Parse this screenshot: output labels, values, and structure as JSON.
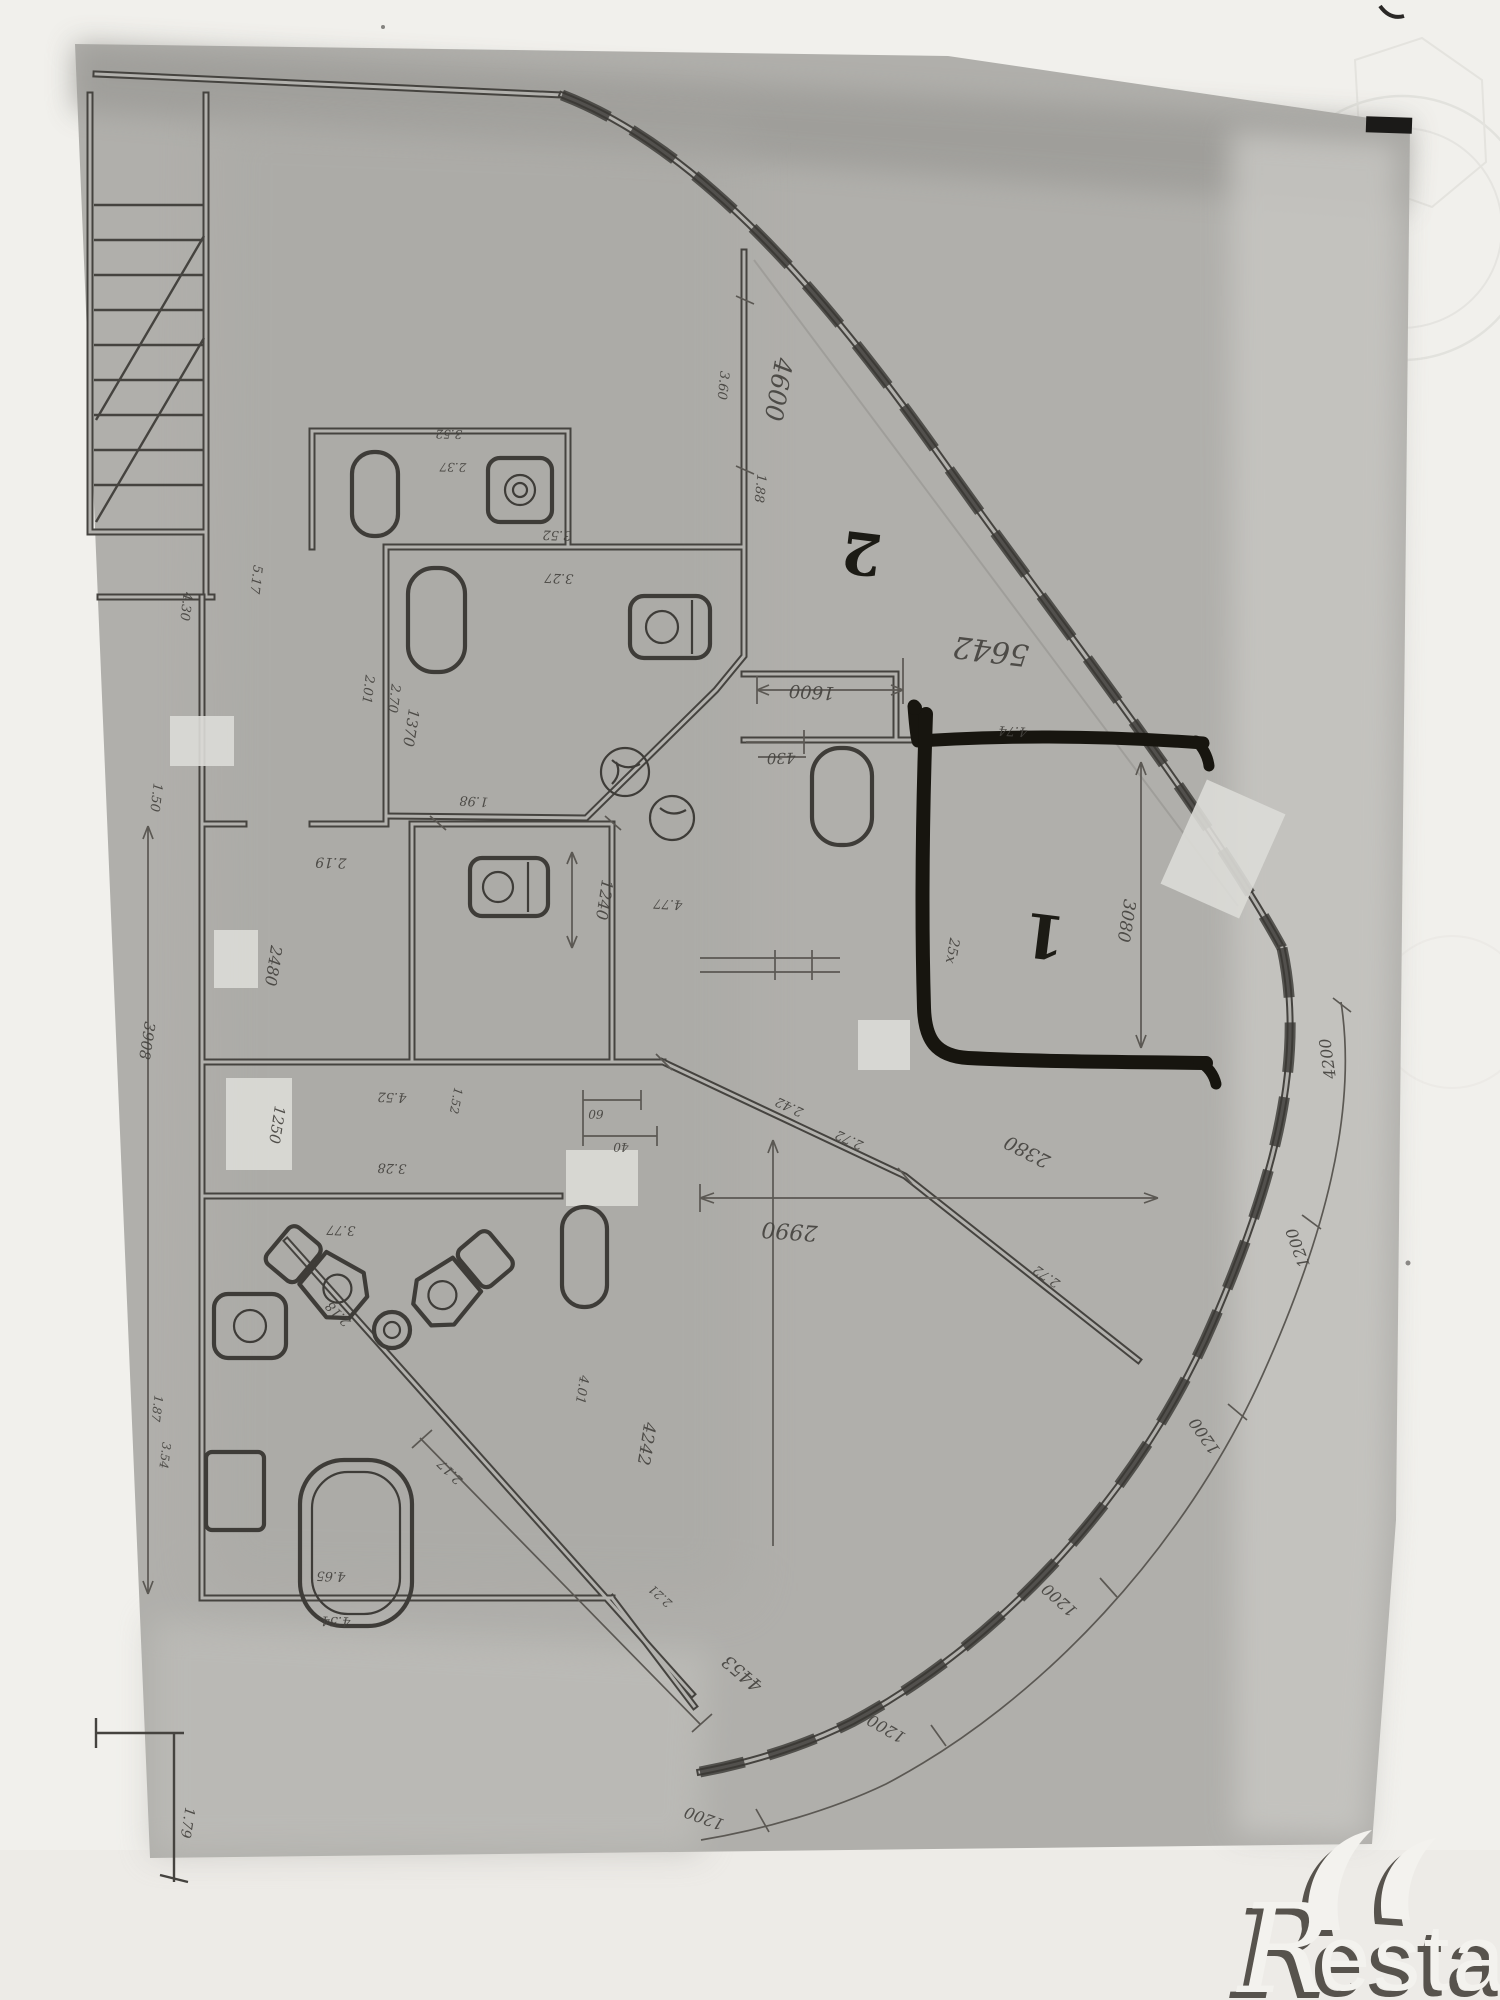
{
  "colors": {
    "paper": "#f1f0ec",
    "sheet": "#b0afab",
    "ink": "#45433f",
    "marker": "#17150f",
    "wmshadow": "#57534d"
  },
  "watermark": {
    "letter_r": "R",
    "rest": "estate"
  },
  "plan": {
    "room_numbers": [
      "1",
      "2"
    ],
    "labels": [
      {
        "t": "2",
        "x": 864,
        "y": 533,
        "r": 187,
        "s": 58,
        "m": 1,
        "n": "room-number-2"
      },
      {
        "t": "1",
        "x": 1047,
        "y": 915,
        "r": 187,
        "s": 60,
        "m": 1,
        "n": "room-number-1"
      },
      {
        "t": "4600",
        "x": 770,
        "y": 388,
        "r": 100,
        "s": 25
      },
      {
        "t": "3.60",
        "x": 719,
        "y": 385,
        "r": 96,
        "s": 13
      },
      {
        "t": "1.88",
        "x": 756,
        "y": 488,
        "r": 96,
        "s": 13
      },
      {
        "t": "5642",
        "x": 992,
        "y": 641,
        "r": 187,
        "s": 30,
        "i": 1
      },
      {
        "t": "1600",
        "x": 812,
        "y": 686,
        "r": 183,
        "s": 18
      },
      {
        "t": "430",
        "x": 781,
        "y": 753,
        "r": 179,
        "s": 15
      },
      {
        "t": "4.74",
        "x": 1013,
        "y": 727,
        "r": 183,
        "s": 13
      },
      {
        "t": "25x",
        "x": 948,
        "y": 950,
        "r": 100,
        "s": 14,
        "i": 1
      },
      {
        "t": "3080",
        "x": 1121,
        "y": 920,
        "r": 99,
        "s": 17
      },
      {
        "t": "3.52",
        "x": 449,
        "y": 430,
        "r": 181,
        "s": 12
      },
      {
        "t": "2.37",
        "x": 453,
        "y": 463,
        "r": 181,
        "s": 12
      },
      {
        "t": "3.52",
        "x": 557,
        "y": 531,
        "r": 182,
        "s": 13
      },
      {
        "t": "3.27",
        "x": 559,
        "y": 574,
        "r": 182,
        "s": 13
      },
      {
        "t": "2.01",
        "x": 364,
        "y": 689,
        "r": 97,
        "s": 13
      },
      {
        "t": "2.70",
        "x": 390,
        "y": 698,
        "r": 97,
        "s": 13
      },
      {
        "t": "1370",
        "x": 406,
        "y": 727,
        "r": 99,
        "s": 15
      },
      {
        "t": "1.98",
        "x": 474,
        "y": 797,
        "r": 183,
        "s": 13
      },
      {
        "t": "1.50",
        "x": 152,
        "y": 797,
        "r": 97,
        "s": 13
      },
      {
        "t": "2.19",
        "x": 331,
        "y": 858,
        "r": 182,
        "s": 14
      },
      {
        "t": "4.77",
        "x": 668,
        "y": 900,
        "r": 183,
        "s": 13
      },
      {
        "t": "1240",
        "x": 599,
        "y": 899,
        "r": 99,
        "s": 16
      },
      {
        "t": "4.30",
        "x": 182,
        "y": 606,
        "r": 97,
        "s": 13
      },
      {
        "t": "5.17",
        "x": 252,
        "y": 579,
        "r": 97,
        "s": 13
      },
      {
        "t": "2480",
        "x": 268,
        "y": 965,
        "r": 99,
        "s": 16
      },
      {
        "t": "1250",
        "x": 272,
        "y": 1124,
        "r": 99,
        "s": 15
      },
      {
        "t": "3908",
        "x": 142,
        "y": 1040,
        "r": 99,
        "s": 15
      },
      {
        "t": "4.52",
        "x": 392,
        "y": 1093,
        "r": 182,
        "s": 13
      },
      {
        "t": "3.28",
        "x": 392,
        "y": 1164,
        "r": 182,
        "s": 13
      },
      {
        "t": "3.77",
        "x": 341,
        "y": 1226,
        "r": 182,
        "s": 13
      },
      {
        "t": "60",
        "x": 596,
        "y": 1110,
        "r": 181,
        "s": 12
      },
      {
        "t": "40",
        "x": 621,
        "y": 1143,
        "r": 181,
        "s": 12
      },
      {
        "t": "1.52",
        "x": 452,
        "y": 1100,
        "r": 100,
        "s": 12
      },
      {
        "t": "2990",
        "x": 790,
        "y": 1224,
        "r": 184,
        "s": 22,
        "i": 1
      },
      {
        "t": "2380",
        "x": 1030,
        "y": 1146,
        "r": 207,
        "s": 19,
        "i": 1
      },
      {
        "t": "2.42",
        "x": 791,
        "y": 1103,
        "r": 205,
        "s": 13
      },
      {
        "t": "2.72",
        "x": 851,
        "y": 1136,
        "r": 205,
        "s": 13
      },
      {
        "t": "2.72",
        "x": 1049,
        "y": 1273,
        "r": 215,
        "s": 13
      },
      {
        "t": "4242",
        "x": 641,
        "y": 1443,
        "r": 99,
        "s": 17,
        "i": 1
      },
      {
        "t": "4.01",
        "x": 578,
        "y": 1389,
        "r": 99,
        "s": 13
      },
      {
        "t": "2.18",
        "x": 341,
        "y": 1311,
        "r": 225,
        "s": 13
      },
      {
        "t": "2.17",
        "x": 453,
        "y": 1469,
        "r": 225,
        "s": 13
      },
      {
        "t": "4.65",
        "x": 331,
        "y": 1572,
        "r": 182,
        "s": 13
      },
      {
        "t": "4.54",
        "x": 336,
        "y": 1617,
        "r": 182,
        "s": 13
      },
      {
        "t": "1.87",
        "x": 153,
        "y": 1408,
        "r": 97,
        "s": 12
      },
      {
        "t": "3.54",
        "x": 161,
        "y": 1455,
        "r": 97,
        "s": 12
      },
      {
        "t": "1.79",
        "x": 183,
        "y": 1822,
        "r": 99,
        "s": 14
      },
      {
        "t": "4453",
        "x": 746,
        "y": 1669,
        "r": 220,
        "s": 18,
        "i": 1
      },
      {
        "t": "2.21",
        "x": 663,
        "y": 1593,
        "r": 222,
        "s": 12
      },
      {
        "t": "4200",
        "x": 1333,
        "y": 1058,
        "r": 262,
        "s": 16
      },
      {
        "t": "1200",
        "x": 1303,
        "y": 1246,
        "r": 250,
        "s": 16
      },
      {
        "t": "1200",
        "x": 1209,
        "y": 1433,
        "r": 235,
        "s": 16
      },
      {
        "t": "1200",
        "x": 1063,
        "y": 1596,
        "r": 222,
        "s": 16
      },
      {
        "t": "1200",
        "x": 889,
        "y": 1724,
        "r": 210,
        "s": 16
      },
      {
        "t": "1200",
        "x": 706,
        "y": 1813,
        "r": 200,
        "s": 16
      }
    ]
  }
}
